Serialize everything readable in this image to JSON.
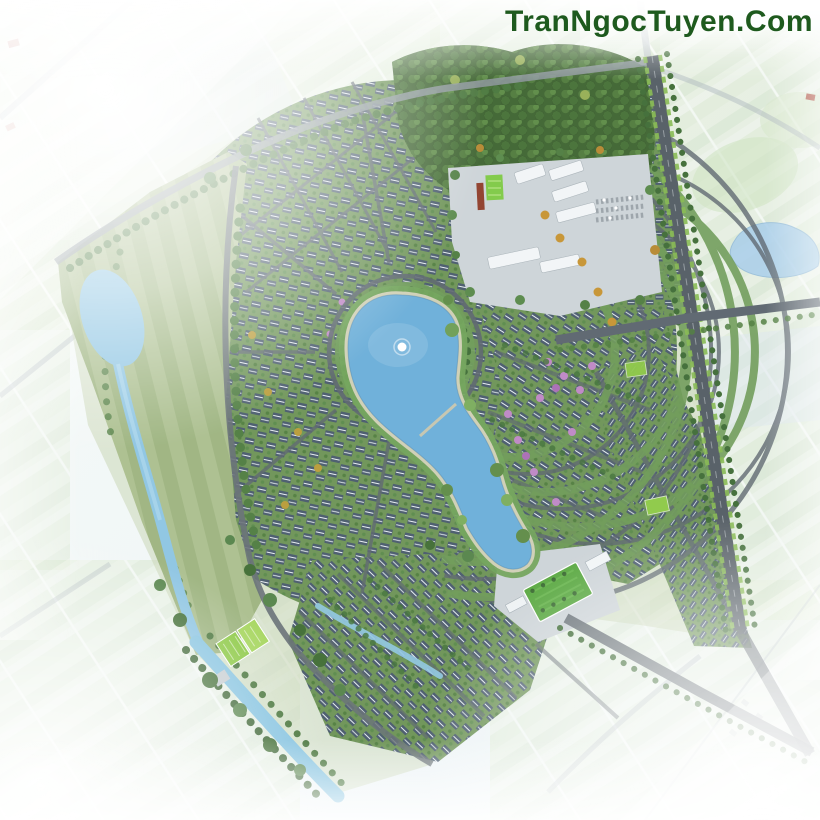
{
  "watermark": {
    "text": "TranNgocTuyen.Com"
  },
  "scene": {
    "description": "Aerial master-plan rendering of a villa community: hook-shaped central lake with a fountain, concentric rings of blue-roofed villas, tree-lined boulevard on the east with a crossroads, forest park and clubhouse plaza with a sports court to the north, lawn entrance plaza to the south-east, landscaped park field with a winding stream on the west, canal along the south-west edge, all surrounded by pale faded farmland with ponds."
  },
  "colors": {
    "watermark_green": "#1e5a1e",
    "background_light": "#f4f8f4",
    "lake_blue": "#69add8",
    "pond_blue": "#a7cde9",
    "river_blue": "#8cc4e2",
    "canal_blue": "#85c3e0",
    "field_green": "#a3b983",
    "forest_deep": "#3c622e",
    "tree_green": "#4c7b3e",
    "residential_green": "#6b9254",
    "roof_slate": "#46586a",
    "roof_ridge": "#e9eff3",
    "road_gray": "#59636c",
    "road_dark": "#515a61",
    "plaza_gray": "#ccd3d7",
    "court_green": "#7dc943",
    "lawn_green": "#55a63c",
    "accent_orange": "#c6922f",
    "accent_pink": "#bd85c4",
    "building_white": "#f2f5f7",
    "accent_red": "#8e3b28",
    "farm_light": "#e0ebd4"
  }
}
